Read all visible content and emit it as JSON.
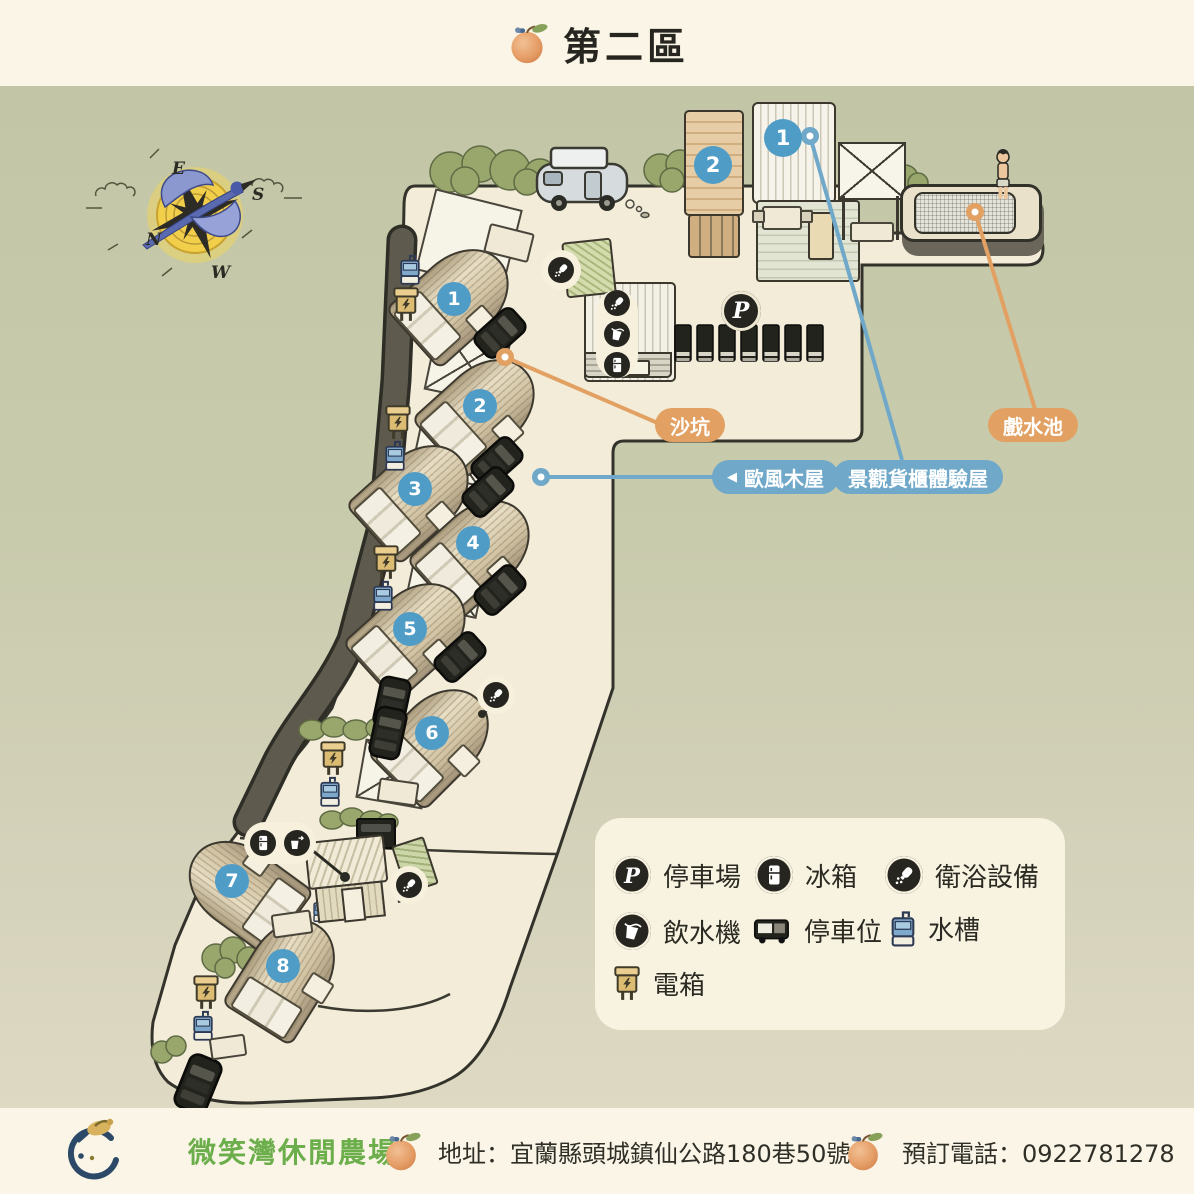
{
  "header": {
    "title": "第二區"
  },
  "map": {
    "compass": {
      "n": "N",
      "e": "E",
      "s": "S",
      "w": "W"
    },
    "cabin_numbers": [
      "1",
      "2",
      "3",
      "4",
      "5",
      "6",
      "7",
      "8"
    ],
    "container_markers": [
      "1",
      "2"
    ],
    "parking_badge": "P",
    "labels": {
      "sandpit": "沙坑",
      "pool": "戲水池",
      "euro_arrow": "◀",
      "euro_cabin": "歐風木屋",
      "container_house": "景觀貨櫃體驗屋"
    },
    "colors": {
      "accent_orange": "#e2a162",
      "accent_blue": "#6fa8c8",
      "badge_blue": "#4f9cc7"
    }
  },
  "legend": {
    "items": [
      {
        "icon": "parking-icon",
        "icon_letter": "P",
        "label": "停車場"
      },
      {
        "icon": "fridge-icon",
        "label": "冰箱"
      },
      {
        "icon": "bath-icon",
        "label": "衛浴設備"
      },
      {
        "icon": "water-dispenser-icon",
        "label": "飲水機"
      },
      {
        "icon": "parking-spot-icon",
        "label": "停車位"
      },
      {
        "icon": "sink-icon",
        "label": "水槽"
      },
      {
        "icon": "electric-box-icon",
        "label": "電箱"
      }
    ]
  },
  "footer": {
    "farm_name": "微笑灣休閒農場",
    "address": "地址：宜蘭縣頭城鎮仙公路180巷50號",
    "phone": "預訂電話：0922781278",
    "farm_green": "#6cae4b"
  }
}
